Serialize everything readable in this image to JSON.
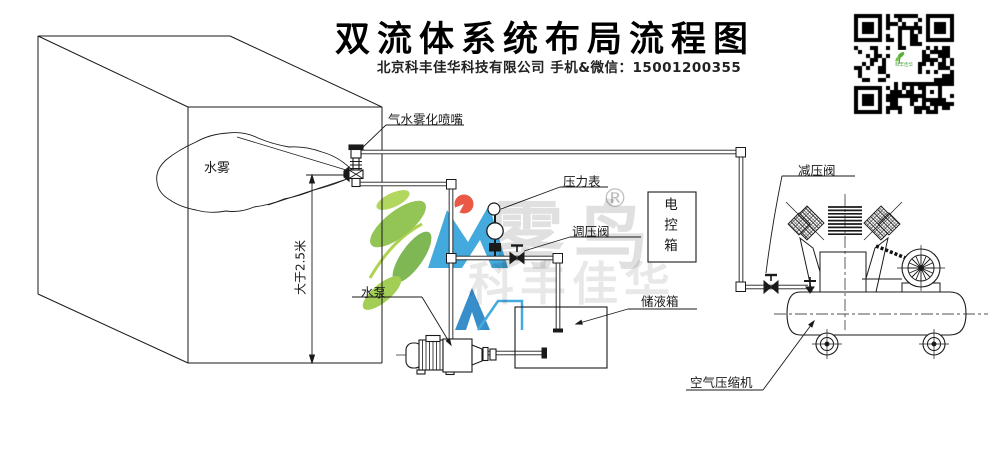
{
  "page": {
    "title": "双流体系统布局流程图",
    "subtitle": "北京科丰佳华科技有限公司 手机&微信：15001200355"
  },
  "diagram": {
    "room": {
      "mist_label": "水雾",
      "dimension_label": "大于2.5米"
    },
    "labels": {
      "nozzle": "气水雾化喷嘴",
      "pressure_gauge": "压力表",
      "pressure_regulating_valve": "调压阀",
      "electric_control_box": "电控箱",
      "water_pump": "水泵",
      "liquid_storage_tank": "储液箱",
      "pressure_reducing_valve": "减压阀",
      "air_compressor": "空气压缩机"
    }
  },
  "watermark": {
    "brand": "雾鸟",
    "registered": "®",
    "company": "科丰佳华",
    "qr_center_text": "科丰佳华"
  },
  "colors": {
    "line": "#1a1a1a",
    "watermark_green": "#7CB83E",
    "watermark_blue": "#2B9FD9",
    "watermark_red": "#E8432C",
    "watermark_gray": "rgba(0,0,0,0.13)"
  }
}
